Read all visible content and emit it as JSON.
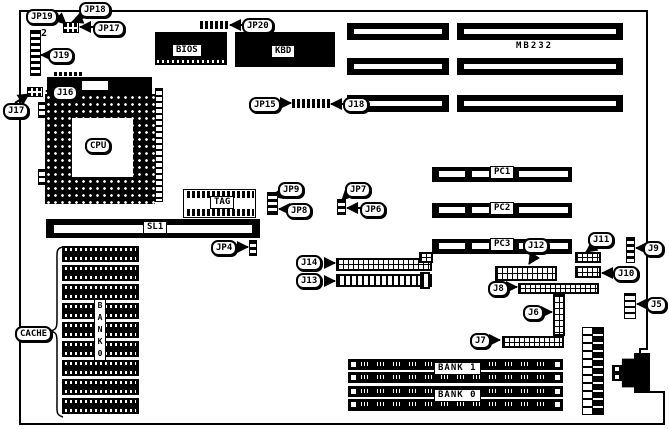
{
  "diagram": {
    "type": "motherboard-layout",
    "model_text": "MB232",
    "j2_marker": "2",
    "ink_color": "#000000",
    "background_color": "#ffffff"
  },
  "callouts": {
    "jp19": "JP19",
    "jp18": "JP18",
    "jp17": "JP17",
    "jp20": "JP20",
    "jp15": "JP15",
    "jp9": "JP9",
    "jp8": "JP8",
    "jp7": "JP7",
    "jp6": "JP6",
    "jp4": "JP4",
    "j19": "J19",
    "j18": "J18",
    "j17": "J17",
    "j16": "J16",
    "j14": "J14",
    "j13": "J13",
    "j12": "J12",
    "j11": "J11",
    "j10": "J10",
    "j9": "J9",
    "j8": "J8",
    "j7": "J7",
    "j6": "J6",
    "j5": "J5",
    "cache": "CACHE"
  },
  "components": {
    "cpu": "CPU",
    "bios": "BIOS",
    "kbd": "KBD",
    "tag": "TAG",
    "sl1": "SL1",
    "pc1": "PC1",
    "pc2": "PC2",
    "pc3": "PC3",
    "bank1": "BANK 1",
    "bank0": "BANK 0",
    "cache_bank_vertical": [
      "B",
      "A",
      "N",
      "K",
      "0"
    ]
  }
}
